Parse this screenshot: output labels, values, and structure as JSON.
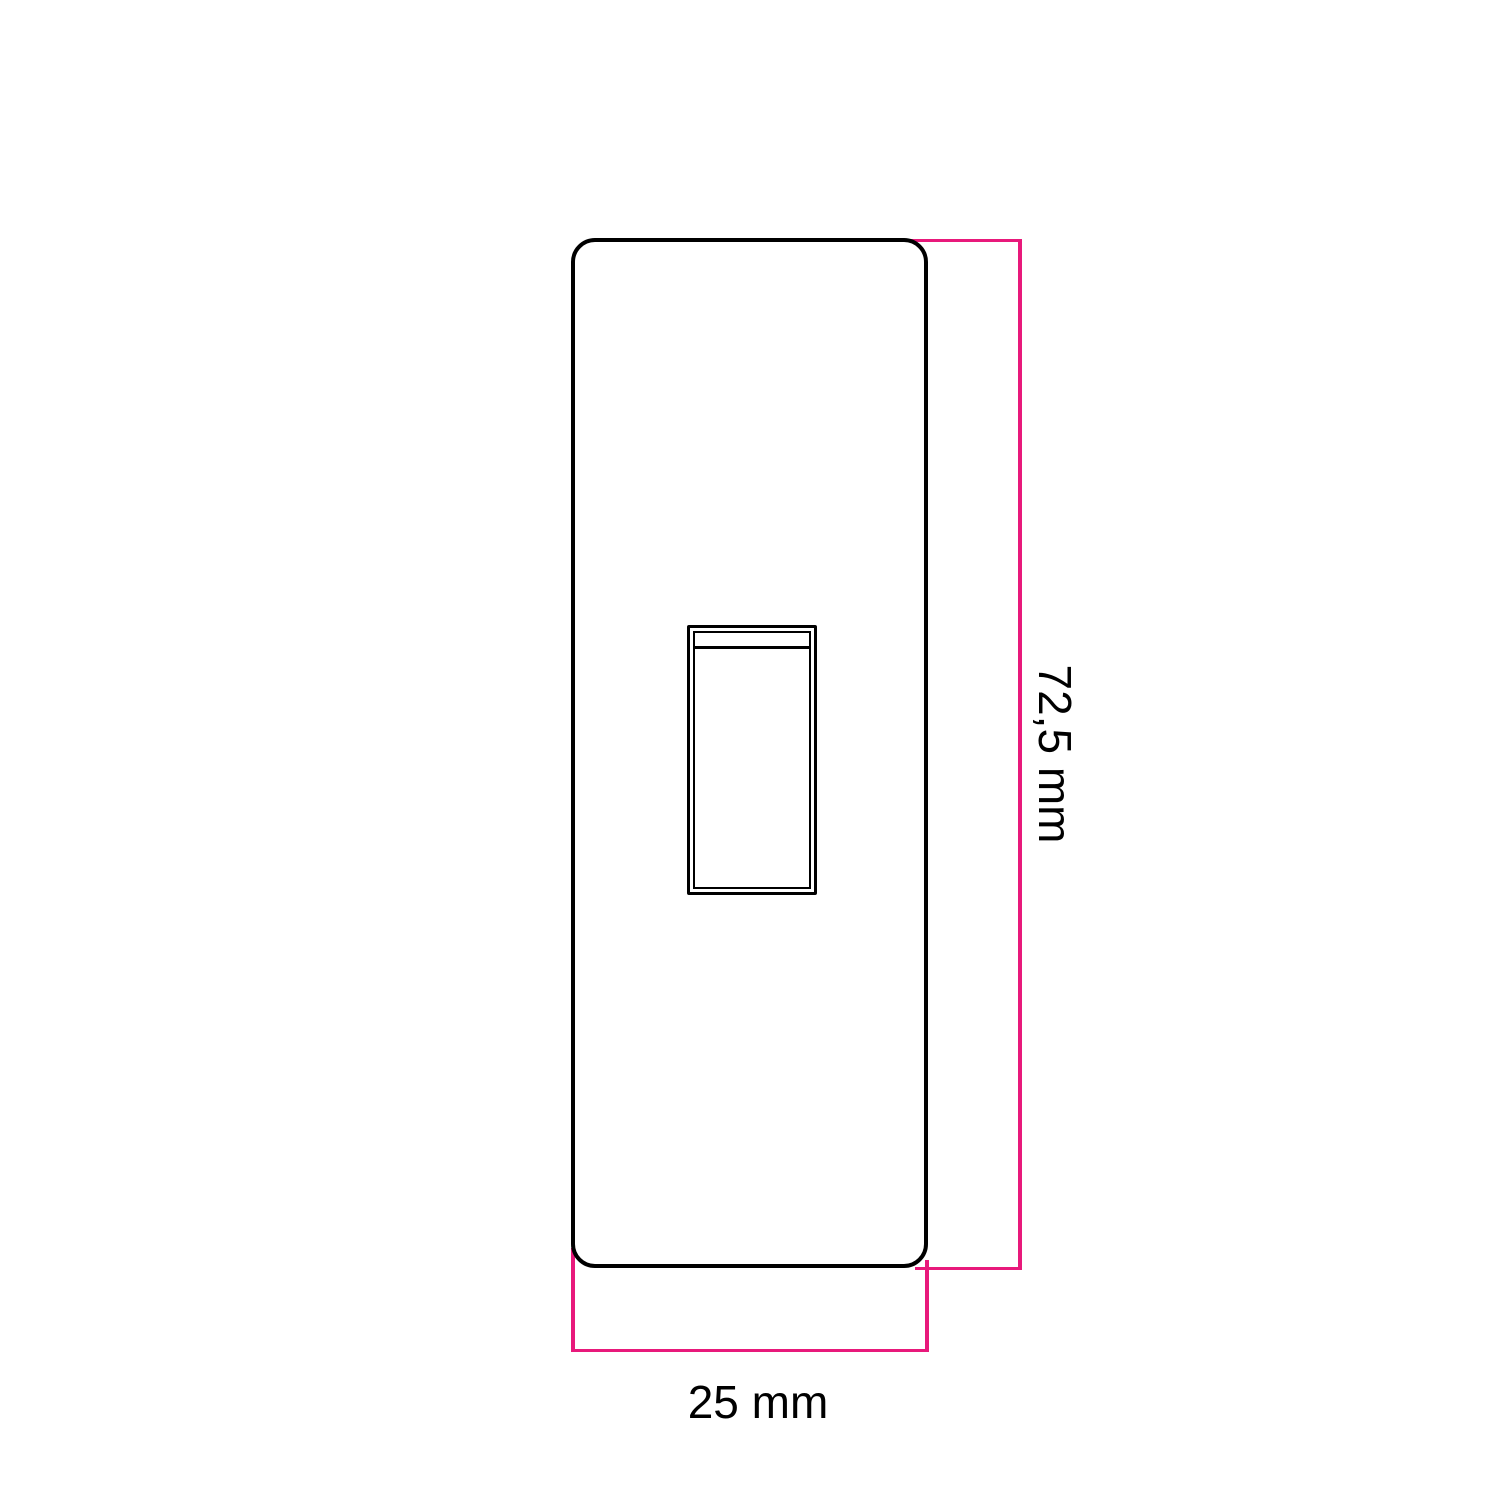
{
  "drawing": {
    "labels": {
      "height": "72,5 mm",
      "width": "25 mm"
    },
    "colors": {
      "outline": "#000000",
      "dimension": "#e8197b",
      "background": "#ffffff"
    }
  }
}
